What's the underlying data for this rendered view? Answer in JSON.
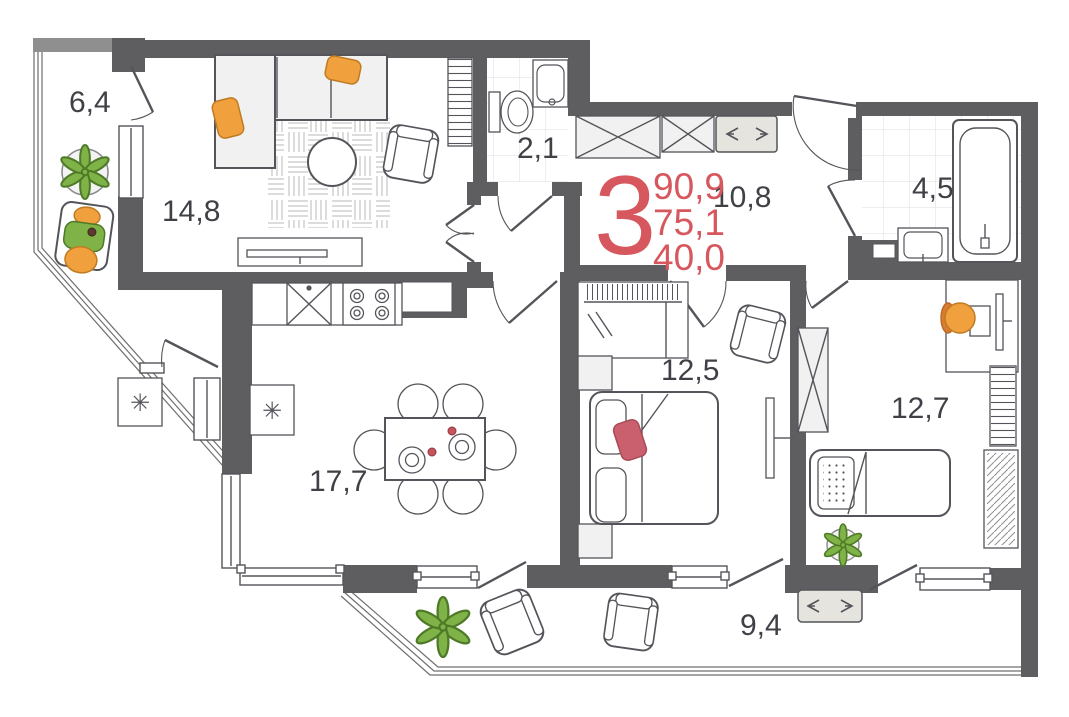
{
  "summary": {
    "rooms_count": "3",
    "total_area": "90,9",
    "area_reduced": "75,1",
    "living_area": "40,0"
  },
  "rooms": {
    "loggia": {
      "area": "6,4"
    },
    "living": {
      "area": "14,8"
    },
    "wc": {
      "area": "2,1"
    },
    "hallway": {
      "area": "10,8"
    },
    "bathroom": {
      "area": "4,5"
    },
    "bedroom": {
      "area": "12,5"
    },
    "kids_room": {
      "area": "12,7"
    },
    "kitchen_living": {
      "area": "17,7"
    },
    "balcony": {
      "area": "9,4"
    }
  },
  "symbols": {
    "appliance_asterisk": "✳"
  },
  "colors": {
    "wall": "#5e5e60",
    "stroke": "#54555a",
    "red": "#d6575d",
    "orange": "#f0a03c",
    "green": "#7fb347",
    "label": "#3f4146",
    "pillow-red": "#ca5f6d",
    "beige": "#e6e4df"
  }
}
